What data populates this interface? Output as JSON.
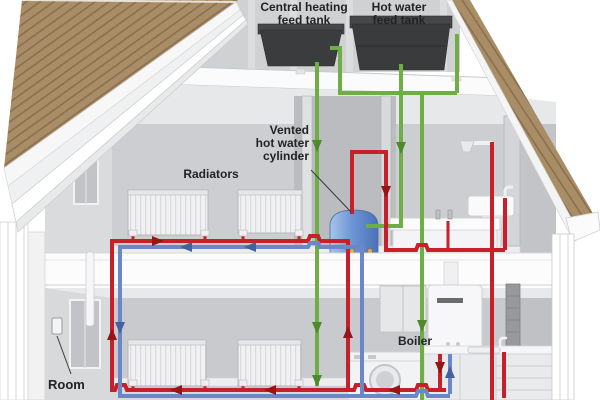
{
  "labels": {
    "central_tank_line1": "Central heating",
    "central_tank_line2": "feed tank",
    "hot_tank_line1": "Hot water",
    "hot_tank_line2": "feed tank",
    "cylinder_line1": "Vented",
    "cylinder_line2": "hot water",
    "cylinder_line3": "cylinder",
    "radiators": "Radiators",
    "boiler": "Boiler",
    "room": "Room"
  },
  "colors": {
    "hot": "#c8202a",
    "return": "#6b87c8",
    "cold": "#6fae45",
    "hot_arrow": "#971419",
    "return_arrow": "#44609e",
    "cold_arrow": "#4c8a2c",
    "roof": "#a98d66",
    "roof_seam": "#8a6f50",
    "tank": "#3b3c3e",
    "cylinder": "#5d86cc",
    "leader": "#3a3a3a"
  },
  "pipes": [
    {
      "id": "cold-feed-main",
      "c": "cold",
      "w": 4,
      "points": [
        [
          317,
          62
        ],
        [
          317,
          386
        ]
      ]
    },
    {
      "id": "cold-vent-left-tank",
      "c": "cold",
      "w": 4,
      "points": [
        [
          330,
          48
        ],
        [
          340,
          48
        ],
        [
          340,
          93
        ]
      ]
    },
    {
      "id": "cold-attic-horizontal",
      "c": "cold",
      "w": 4,
      "points": [
        [
          338,
          93
        ],
        [
          457,
          93
        ]
      ]
    },
    {
      "id": "cold-right-tank-vent",
      "c": "cold",
      "w": 4,
      "points": [
        [
          457,
          93
        ],
        [
          457,
          34
        ]
      ]
    },
    {
      "id": "cold-feed-cylinder",
      "c": "cold",
      "w": 4,
      "points": [
        [
          401,
          64
        ],
        [
          401,
          226
        ],
        [
          366,
          226
        ]
      ]
    },
    {
      "id": "cold-feed-kitchen",
      "c": "cold",
      "w": 4,
      "points": [
        [
          422,
          93
        ],
        [
          422,
          400
        ]
      ]
    },
    {
      "id": "hot-left-riser",
      "c": "hot",
      "w": 4,
      "points": [
        [
          112,
          239
        ],
        [
          112,
          392
        ]
      ]
    },
    {
      "id": "hot-upper-run",
      "c": "hot",
      "w": 4,
      "points": [
        [
          110,
          241
        ],
        [
          308,
          241
        ],
        [
          310,
          236
        ],
        [
          318,
          236
        ],
        [
          320,
          241
        ],
        [
          348,
          241
        ]
      ]
    },
    {
      "id": "hot-primary-riser",
      "c": "hot",
      "w": 4,
      "points": [
        [
          348,
          239
        ],
        [
          348,
          390
        ]
      ]
    },
    {
      "id": "hot-rad-stub-1",
      "c": "hot",
      "w": 3,
      "points": [
        [
          133,
          234
        ],
        [
          133,
          241
        ]
      ]
    },
    {
      "id": "hot-rad-stub-2",
      "c": "hot",
      "w": 3,
      "points": [
        [
          205,
          234
        ],
        [
          205,
          241
        ]
      ]
    },
    {
      "id": "hot-rad-stub-3",
      "c": "hot",
      "w": 3,
      "points": [
        [
          243,
          234
        ],
        [
          243,
          241
        ]
      ]
    },
    {
      "id": "hot-rad-stub-4",
      "c": "hot",
      "w": 3,
      "points": [
        [
          299,
          234
        ],
        [
          299,
          241
        ]
      ]
    },
    {
      "id": "hot-cylinder-vent",
      "c": "hot",
      "w": 4,
      "points": [
        [
          352,
          214
        ],
        [
          352,
          152
        ],
        [
          386,
          152
        ],
        [
          386,
          250
        ]
      ]
    },
    {
      "id": "hot-bath-run",
      "c": "hot",
      "w": 4,
      "points": [
        [
          384,
          250
        ],
        [
          416,
          250
        ],
        [
          418,
          245
        ],
        [
          426,
          245
        ],
        [
          428,
          250
        ],
        [
          505,
          250
        ]
      ]
    },
    {
      "id": "hot-basin-stub",
      "c": "hot",
      "w": 4,
      "points": [
        [
          505,
          250
        ],
        [
          505,
          198
        ]
      ]
    },
    {
      "id": "hot-tub-stub",
      "c": "hot",
      "w": 3,
      "points": [
        [
          448,
          250
        ],
        [
          448,
          221
        ]
      ]
    },
    {
      "id": "hot-shower-kitchen",
      "c": "hot",
      "w": 4,
      "points": [
        [
          492,
          142
        ],
        [
          492,
          400
        ]
      ]
    },
    {
      "id": "hot-kitchen-tap",
      "c": "hot",
      "w": 4,
      "points": [
        [
          504,
          352
        ],
        [
          504,
          398
        ]
      ]
    },
    {
      "id": "hot-bottom-run",
      "c": "hot",
      "w": 4,
      "points": [
        [
          112,
          390
        ],
        [
          115,
          390
        ],
        [
          117,
          385
        ],
        [
          125,
          385
        ],
        [
          127,
          390
        ],
        [
          354,
          390
        ],
        [
          356,
          385
        ],
        [
          364,
          385
        ],
        [
          366,
          390
        ],
        [
          416,
          390
        ],
        [
          418,
          385
        ],
        [
          426,
          385
        ],
        [
          428,
          390
        ],
        [
          446,
          390
        ]
      ]
    },
    {
      "id": "hot-boiler-drop",
      "c": "hot",
      "w": 4,
      "points": [
        [
          440,
          354
        ],
        [
          440,
          388
        ]
      ]
    },
    {
      "id": "hot-rad-stub-5",
      "c": "hot",
      "w": 3,
      "points": [
        [
          133,
          382
        ],
        [
          133,
          390
        ]
      ]
    },
    {
      "id": "hot-rad-stub-6",
      "c": "hot",
      "w": 3,
      "points": [
        [
          205,
          382
        ],
        [
          205,
          390
        ]
      ]
    },
    {
      "id": "hot-rad-stub-7",
      "c": "hot",
      "w": 3,
      "points": [
        [
          243,
          382
        ],
        [
          243,
          390
        ]
      ]
    },
    {
      "id": "hot-rad-stub-8",
      "c": "hot",
      "w": 3,
      "points": [
        [
          299,
          382
        ],
        [
          299,
          390
        ]
      ]
    },
    {
      "id": "return-left-riser",
      "c": "return",
      "w": 4,
      "points": [
        [
          120,
          245
        ],
        [
          120,
          398
        ]
      ]
    },
    {
      "id": "return-upper-run",
      "c": "return",
      "w": 4,
      "points": [
        [
          118,
          247
        ],
        [
          308,
          247
        ],
        [
          310,
          243
        ],
        [
          318,
          243
        ],
        [
          320,
          247
        ],
        [
          362,
          247
        ]
      ]
    },
    {
      "id": "return-riser",
      "c": "return",
      "w": 4,
      "points": [
        [
          362,
          245
        ],
        [
          362,
          398
        ]
      ]
    },
    {
      "id": "return-bottom-run",
      "c": "return",
      "w": 4,
      "points": [
        [
          120,
          396
        ],
        [
          416,
          396
        ],
        [
          418,
          391
        ],
        [
          426,
          391
        ],
        [
          428,
          396
        ],
        [
          450,
          396
        ]
      ]
    },
    {
      "id": "return-boiler-drop",
      "c": "return",
      "w": 4,
      "points": [
        [
          450,
          354
        ],
        [
          450,
          394
        ]
      ]
    }
  ],
  "arrows": [
    {
      "c": "cold_arrow",
      "x": 317,
      "y": 146,
      "dir": "down"
    },
    {
      "c": "cold_arrow",
      "x": 401,
      "y": 148,
      "dir": "down"
    },
    {
      "c": "cold_arrow",
      "x": 317,
      "y": 328,
      "dir": "down"
    },
    {
      "c": "cold_arrow",
      "x": 317,
      "y": 381,
      "dir": "down"
    },
    {
      "c": "cold_arrow",
      "x": 422,
      "y": 326,
      "dir": "down"
    },
    {
      "c": "hot_arrow",
      "x": 386,
      "y": 192,
      "dir": "down"
    },
    {
      "c": "hot_arrow",
      "x": 158,
      "y": 241,
      "dir": "right"
    },
    {
      "c": "hot_arrow",
      "x": 112,
      "y": 334,
      "dir": "up"
    },
    {
      "c": "hot_arrow",
      "x": 348,
      "y": 332,
      "dir": "up"
    },
    {
      "c": "hot_arrow",
      "x": 176,
      "y": 390,
      "dir": "left"
    },
    {
      "c": "hot_arrow",
      "x": 270,
      "y": 390,
      "dir": "left"
    },
    {
      "c": "hot_arrow",
      "x": 394,
      "y": 390,
      "dir": "left"
    },
    {
      "c": "hot_arrow",
      "x": 440,
      "y": 368,
      "dir": "down"
    },
    {
      "c": "return_arrow",
      "x": 186,
      "y": 247,
      "dir": "left"
    },
    {
      "c": "return_arrow",
      "x": 250,
      "y": 247,
      "dir": "left"
    },
    {
      "c": "return_arrow",
      "x": 120,
      "y": 328,
      "dir": "down"
    },
    {
      "c": "return_arrow",
      "x": 450,
      "y": 372,
      "dir": "up"
    }
  ],
  "leader_lines": [
    {
      "x1": 311,
      "y1": 170,
      "x2": 351,
      "y2": 212
    },
    {
      "x1": 57,
      "y1": 336,
      "x2": 71,
      "y2": 374
    }
  ]
}
